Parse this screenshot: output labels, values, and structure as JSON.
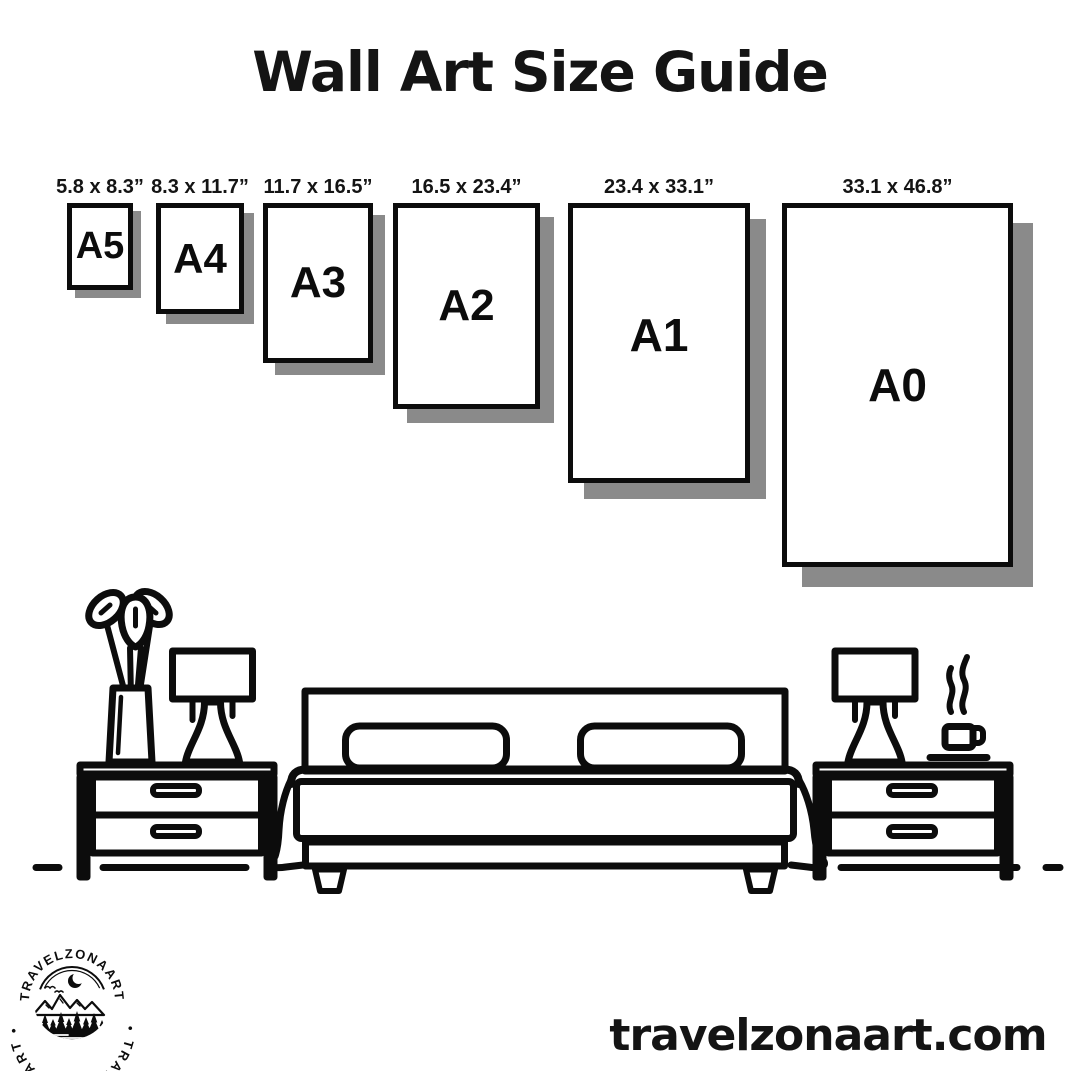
{
  "title": "Wall Art Size Guide",
  "sizes": [
    {
      "label": "A5",
      "dimensions": "5.8 x 8.3”"
    },
    {
      "label": "A4",
      "dimensions": "8.3 x 11.7”"
    },
    {
      "label": "A3",
      "dimensions": "11.7 x 16.5”"
    },
    {
      "label": "A2",
      "dimensions": "16.5 x 23.4”"
    },
    {
      "label": "A1",
      "dimensions": "23.4 x 33.1”"
    },
    {
      "label": "A0",
      "dimensions": "33.1 x 46.8”"
    }
  ],
  "website": "travelzonaart.com",
  "logo": {
    "ring_text_top": "• TRAVELZONAART •",
    "ring_text_bottom": "• TRAVELZONAART •",
    "scene_icons": [
      "crescent-moon",
      "birds",
      "mountains",
      "pine-trees",
      "lake"
    ]
  },
  "illustration": {
    "items": [
      "flower-vase",
      "table-lamp",
      "nightstand",
      "double-bed",
      "nightstand",
      "table-lamp",
      "steaming-cup"
    ]
  },
  "colors": {
    "ink": "#0c0c0c",
    "shadow": "#8a8a8a",
    "background": "#ffffff"
  }
}
